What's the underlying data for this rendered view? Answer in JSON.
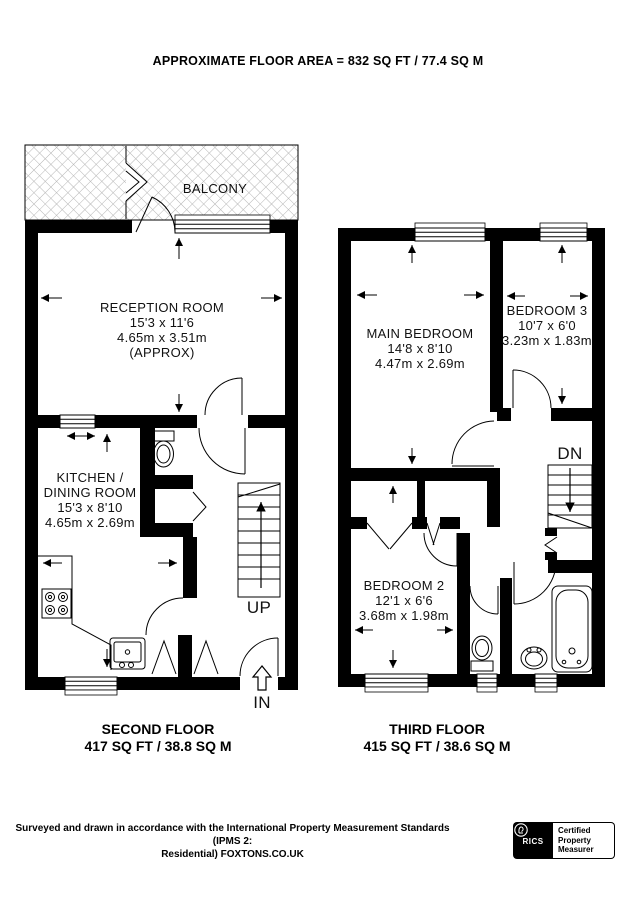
{
  "header": {
    "title": "APPROXIMATE FLOOR AREA = 832 SQ FT / 77.4 SQ M"
  },
  "second_floor": {
    "label": "SECOND FLOOR",
    "area": "417 SQ FT / 38.8 SQ M",
    "balcony_label": "BALCONY",
    "reception": {
      "name": "RECEPTION ROOM",
      "imperial": "15'3 x 11'6",
      "metric": "4.65m x 3.51m",
      "approx": "(APPROX)"
    },
    "kitchen": {
      "name_line1": "KITCHEN /",
      "name_line2": "DINING ROOM",
      "imperial": "15'3 x 8'10",
      "metric": "4.65m x 2.69m"
    },
    "stairs_label": "UP",
    "entrance_label": "IN"
  },
  "third_floor": {
    "label": "THIRD FLOOR",
    "area": "415 SQ FT / 38.6 SQ M",
    "main_bedroom": {
      "name": "MAIN BEDROOM",
      "imperial": "14'8 x 8'10",
      "metric": "4.47m x 2.69m"
    },
    "bedroom_3": {
      "name": "BEDROOM 3",
      "imperial": "10'7 x 6'0",
      "metric": "3.23m x 1.83m"
    },
    "bedroom_2": {
      "name": "BEDROOM 2",
      "imperial": "12'1 x 6'6",
      "metric": "3.68m x 1.98m"
    },
    "stairs_label": "DN"
  },
  "footer": {
    "disclaimer_lines": [
      "Surveyed and drawn in accordance with the International Property Measurement Standards (IPMS 2:",
      "Residential) FOXTONS.CO.UK"
    ],
    "rics_badge": {
      "brand": "RICS",
      "cert_lines": [
        "Certified",
        "Property",
        "Measurer"
      ]
    }
  },
  "colors": {
    "wall": "#000000",
    "background": "#ffffff",
    "hatch_line": "#b5b5b5",
    "text": "#111111"
  }
}
